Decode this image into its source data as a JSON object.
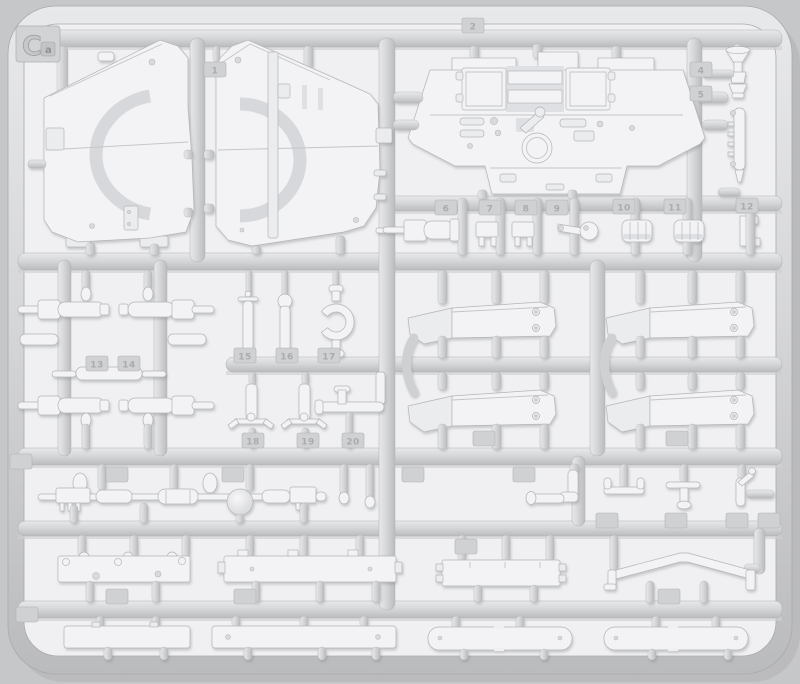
{
  "scene": {
    "description": "Light-gray injection-molded plastic model kit sprue (parts tree) photographed on a gray background, containing tank hull panels, fenders, cylinders, axles and numerous small parts",
    "sprue_code": {
      "letter": "C",
      "sub": "a"
    }
  },
  "colors": {
    "background": "#c6c7c9",
    "pocket": "#f0f0f2",
    "runner_light": "#e8e9ea",
    "runner_mid": "#d5d6d8",
    "runner_dark": "#bcbdbf",
    "part_fill": "#f3f3f5",
    "part_line": "#b4b5b7",
    "tag_fill": "#d0d1d3",
    "tag_text": "#aaabad"
  },
  "part_tags": [
    {
      "label": "1",
      "x": 204,
      "y": 62
    },
    {
      "label": "2",
      "x": 462,
      "y": 18
    },
    {
      "label": "4",
      "x": 690,
      "y": 62
    },
    {
      "label": "5",
      "x": 690,
      "y": 86
    },
    {
      "label": "6",
      "x": 435,
      "y": 200
    },
    {
      "label": "7",
      "x": 479,
      "y": 200
    },
    {
      "label": "8",
      "x": 515,
      "y": 200
    },
    {
      "label": "9",
      "x": 546,
      "y": 200
    },
    {
      "label": "10",
      "x": 613,
      "y": 199
    },
    {
      "label": "11",
      "x": 664,
      "y": 199
    },
    {
      "label": "12",
      "x": 736,
      "y": 198
    },
    {
      "label": "13",
      "x": 86,
      "y": 356
    },
    {
      "label": "14",
      "x": 118,
      "y": 356
    },
    {
      "label": "15",
      "x": 234,
      "y": 348
    },
    {
      "label": "16",
      "x": 276,
      "y": 348
    },
    {
      "label": "17",
      "x": 318,
      "y": 348
    },
    {
      "label": "18",
      "x": 242,
      "y": 433
    },
    {
      "label": "19",
      "x": 297,
      "y": 433
    },
    {
      "label": "20",
      "x": 342,
      "y": 433
    },
    {
      "label": "",
      "x": 106,
      "y": 467
    },
    {
      "label": "",
      "x": 222,
      "y": 467
    },
    {
      "label": "",
      "x": 402,
      "y": 467
    },
    {
      "label": "",
      "x": 513,
      "y": 467
    },
    {
      "label": "",
      "x": 473,
      "y": 431
    },
    {
      "label": "",
      "x": 666,
      "y": 431
    },
    {
      "label": "",
      "x": 596,
      "y": 513
    },
    {
      "label": "",
      "x": 665,
      "y": 513
    },
    {
      "label": "",
      "x": 726,
      "y": 513
    },
    {
      "label": "",
      "x": 758,
      "y": 513
    },
    {
      "label": "",
      "x": 455,
      "y": 539
    },
    {
      "label": "",
      "x": 658,
      "y": 589
    },
    {
      "label": "",
      "x": 106,
      "y": 589
    },
    {
      "label": "",
      "x": 234,
      "y": 589
    },
    {
      "label": "",
      "x": 16,
      "y": 607
    },
    {
      "label": "",
      "x": 10,
      "y": 454
    }
  ]
}
